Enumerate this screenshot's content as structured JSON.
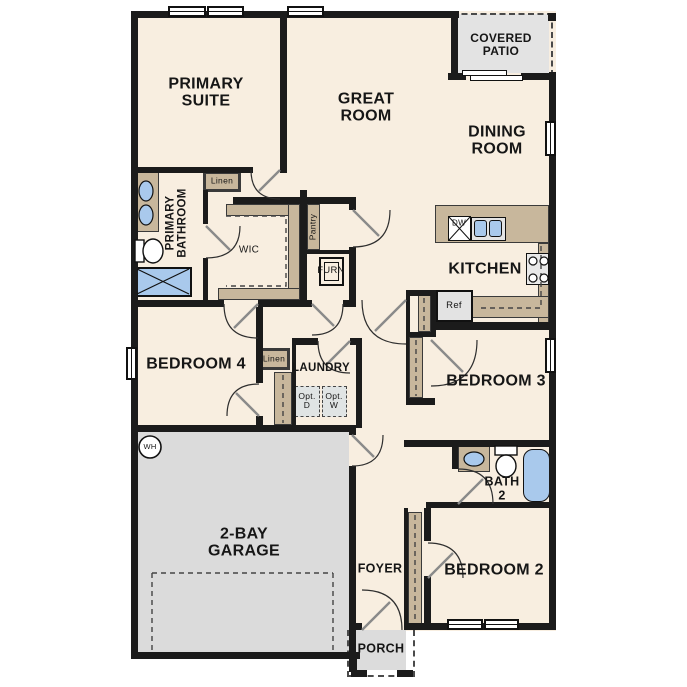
{
  "colors": {
    "wall": "#1b1b1b",
    "floor": "#f8eee0",
    "cabinetry_tan": "#c8b79c",
    "garage_gray": "#dbdbdb",
    "patio_gray": "#e3e3e3",
    "fixture_blue": "#a9c9ec",
    "appliance_gray": "#e4e4e4"
  },
  "rooms": {
    "primary_suite": {
      "label": "PRIMARY\nSUITE"
    },
    "great_room": {
      "label": "GREAT\nROOM"
    },
    "dining_room": {
      "label": "DINING\nROOM"
    },
    "covered_patio": {
      "label": "COVERED\nPATIO"
    },
    "kitchen": {
      "label": "KITCHEN"
    },
    "primary_bathroom": {
      "label": "PRIMARY\nBATHROOM"
    },
    "wic": {
      "label": "WIC"
    },
    "bedroom_4": {
      "label": "BEDROOM 4"
    },
    "laundry": {
      "label": "LAUNDRY"
    },
    "bedroom_3": {
      "label": "BEDROOM 3"
    },
    "bath_2": {
      "label": "BATH\n2"
    },
    "bedroom_2": {
      "label": "BEDROOM 2"
    },
    "garage": {
      "label": "2-BAY\nGARAGE"
    },
    "foyer": {
      "label": "FOYER"
    },
    "porch": {
      "label": "PORCH"
    }
  },
  "fixtures": {
    "linen_bath": {
      "label": "Linen"
    },
    "linen_hall": {
      "label": "Linen"
    },
    "pantry": {
      "label": "Pantry"
    },
    "furnace": {
      "label": "FURN"
    },
    "water_heater": {
      "label": "WH"
    },
    "refrigerator": {
      "label": "Ref"
    },
    "dishwasher": {
      "label": "DW"
    },
    "optional_dryer": {
      "label": "Opt.\nD"
    },
    "optional_washer": {
      "label": "Opt.\nW"
    }
  }
}
